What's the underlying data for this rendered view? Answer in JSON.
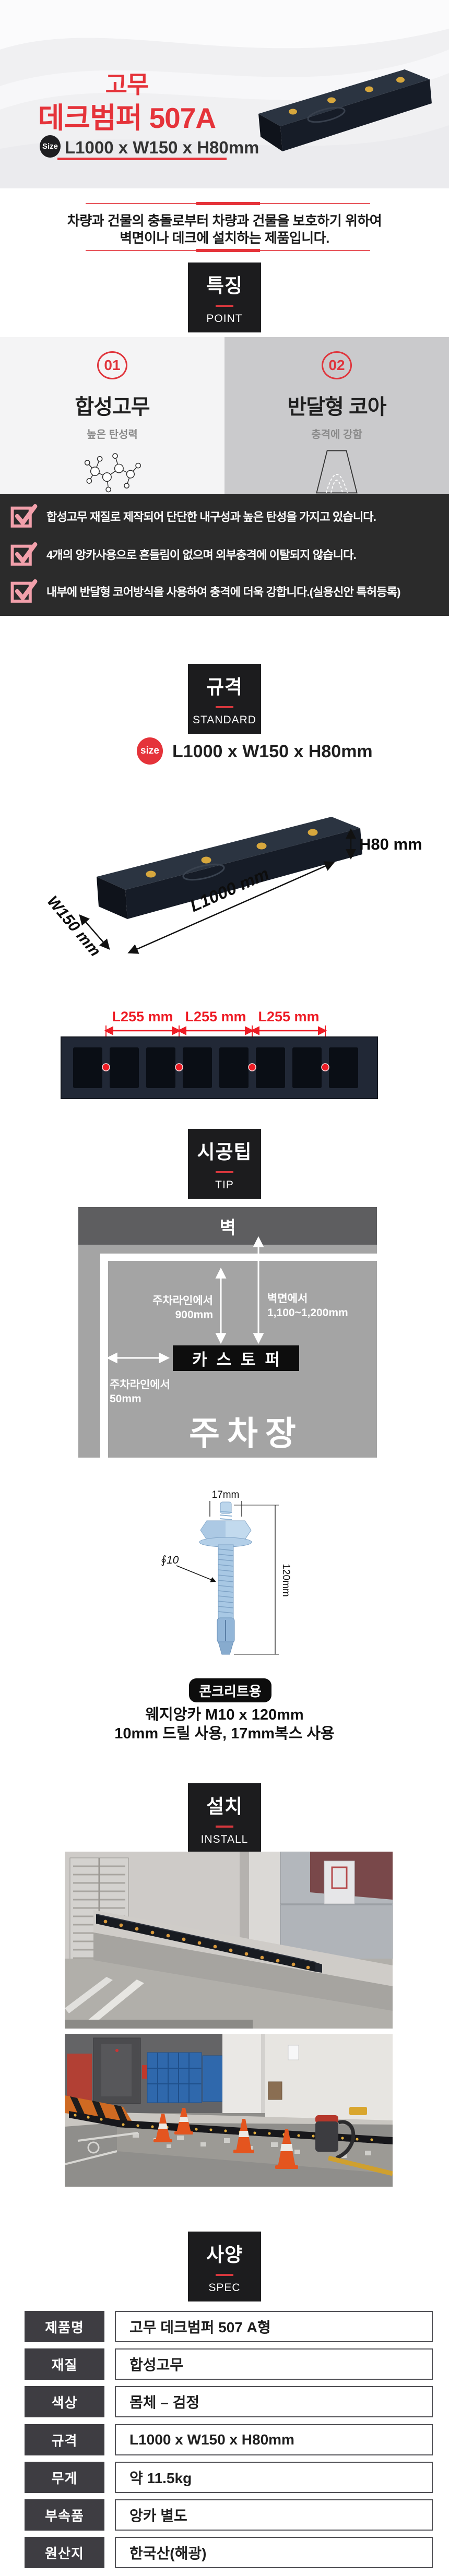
{
  "colors": {
    "accent_red": "#e5333a",
    "check_pink": "#f2a0ab",
    "dark_section": "#2b2b2b",
    "label_box": "#1c1c1e",
    "dimension_red": "#ee1c25"
  },
  "hero": {
    "title_line1": "고무",
    "title_line2": "데크범퍼 507A",
    "size_badge_label": "Size",
    "size_value": "L1000 x W150 x H80mm"
  },
  "intro": {
    "line1": "차량과 건물의 충돌로부터 차량과 건물을 보호하기 위하여",
    "line2": "벽면이나 데크에 설치하는 제품입니다."
  },
  "sections": {
    "point": {
      "kr": "특징",
      "en": "POINT"
    },
    "standard": {
      "kr": "규격",
      "en": "STANDARD"
    },
    "tip": {
      "kr": "시공팁",
      "en": "TIP"
    },
    "install": {
      "kr": "설치",
      "en": "INSTALL"
    },
    "spec": {
      "kr": "사양",
      "en": "SPEC"
    }
  },
  "features": [
    {
      "number": "01",
      "title": "합성고무",
      "desc": "높은 탄성력",
      "icon": "molecule-icon"
    },
    {
      "number": "02",
      "title": "반달형 코아",
      "desc": "충격에 강함",
      "icon": "half-moon-core-icon"
    }
  ],
  "checklist": [
    "합성고무 재질로 제작되어 단단한 내구성과 높은 탄성을 가지고 있습니다.",
    "4개의 앙카사용으로 흔들림이 없으며 외부충격에 이탈되지 않습니다.",
    "내부에 반달형 코어방식을 사용하여 충격에 더욱 강합니다.(실용신안 특허등록)"
  ],
  "standard": {
    "size_badge_label": "size",
    "size_value": "L1000 x W150 x H80mm",
    "dim_height": "H80 mm",
    "dim_length": "L1000 mm",
    "dim_width": "W150 mm",
    "pitch_labels": [
      "L255 mm",
      "L255 mm",
      "L255 mm"
    ]
  },
  "tip_diagram": {
    "wall": "벽",
    "from_line_label": "주차라인에서",
    "from_line_value": "900mm",
    "from_wall_label": "벽면에서",
    "from_wall_value": "1,100~1,200mm",
    "stopper": "카스토퍼",
    "offset_label": "주차라인에서",
    "offset_value": "50mm",
    "parking": "주차장"
  },
  "anchor": {
    "top_dim": "17mm",
    "dia": "∮10",
    "length_dim": "120mm",
    "badge": "콘크리트용",
    "line1": "웨지앙카 M10 x 120mm",
    "line2": "10mm 드릴 사용, 17mm복스 사용"
  },
  "spec_table": {
    "rows": [
      {
        "label": "제품명",
        "value": "고무 데크범퍼 507 A형"
      },
      {
        "label": "재질",
        "value": "합성고무"
      },
      {
        "label": "색상",
        "value": "몸체 – 검정"
      },
      {
        "label": "규격",
        "value": "L1000 x W150 x H80mm"
      },
      {
        "label": "무게",
        "value": "약 11.5kg"
      },
      {
        "label": "부속품",
        "value": "앙카 별도"
      },
      {
        "label": "원산지",
        "value": "한국산(해광)"
      }
    ]
  }
}
